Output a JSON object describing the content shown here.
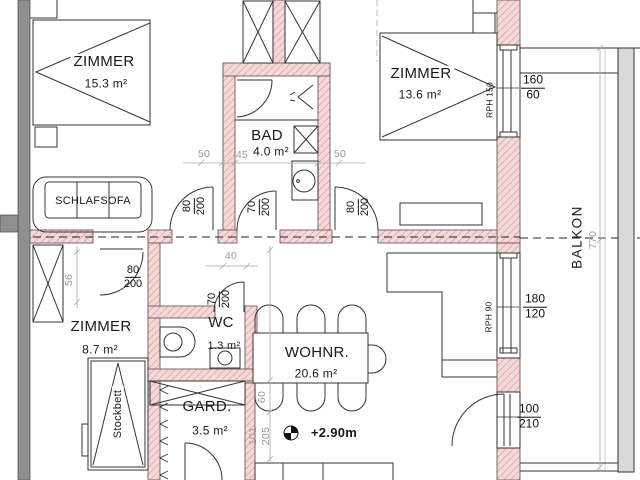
{
  "colors": {
    "wall_fill": "#f6d9d9",
    "wall_hatch": "#d79292",
    "concrete_gray": "#8f8f8f",
    "dim_gray": "#9a9a9a",
    "line": "#2a2a2a"
  },
  "rooms": {
    "zimmer1": {
      "name": "ZIMMER",
      "area": "15.3 m²"
    },
    "zimmer2": {
      "name": "ZIMMER",
      "area": "13.6 m²"
    },
    "zimmer3": {
      "name": "ZIMMER",
      "area": "8.7 m²"
    },
    "bad": {
      "name": "BAD",
      "area": "4.0 m²"
    },
    "wc": {
      "name": "WC",
      "area": "1.3 m²"
    },
    "wohnzimmer": {
      "name": "WOHNR.",
      "area": "20.6 m²"
    },
    "garderobe": {
      "name": "GARD.",
      "area": "3.5 m²"
    },
    "balkon": {
      "name": "BALKON"
    }
  },
  "furniture": {
    "schlafsofa": "SCHLAFSOFA",
    "stockbett": "Stockbett"
  },
  "level_marker": {
    "value": "+2.90m"
  },
  "doors": {
    "zimmer1": {
      "w": "80",
      "h": "200"
    },
    "bad": {
      "w": "70",
      "h": "200"
    },
    "zimmer2": {
      "w": "80",
      "h": "200"
    },
    "zimmer3": {
      "w": "80",
      "h": "200"
    },
    "wc": {
      "w": "70",
      "h": "200"
    },
    "balkon": {
      "w": "100",
      "h": "210"
    }
  },
  "windows": {
    "zimmer2": {
      "parapet": "RPH 150",
      "w": "160",
      "h": "60"
    },
    "wohnzimmer": {
      "parapet": "RPH 90",
      "w": "180",
      "h": "120"
    }
  },
  "dims": {
    "a": "50",
    "b": "45",
    "c": "50",
    "d": "40",
    "e": "56",
    "f": "60",
    "g": "101",
    "h": "205",
    "balkon_length": "770"
  }
}
